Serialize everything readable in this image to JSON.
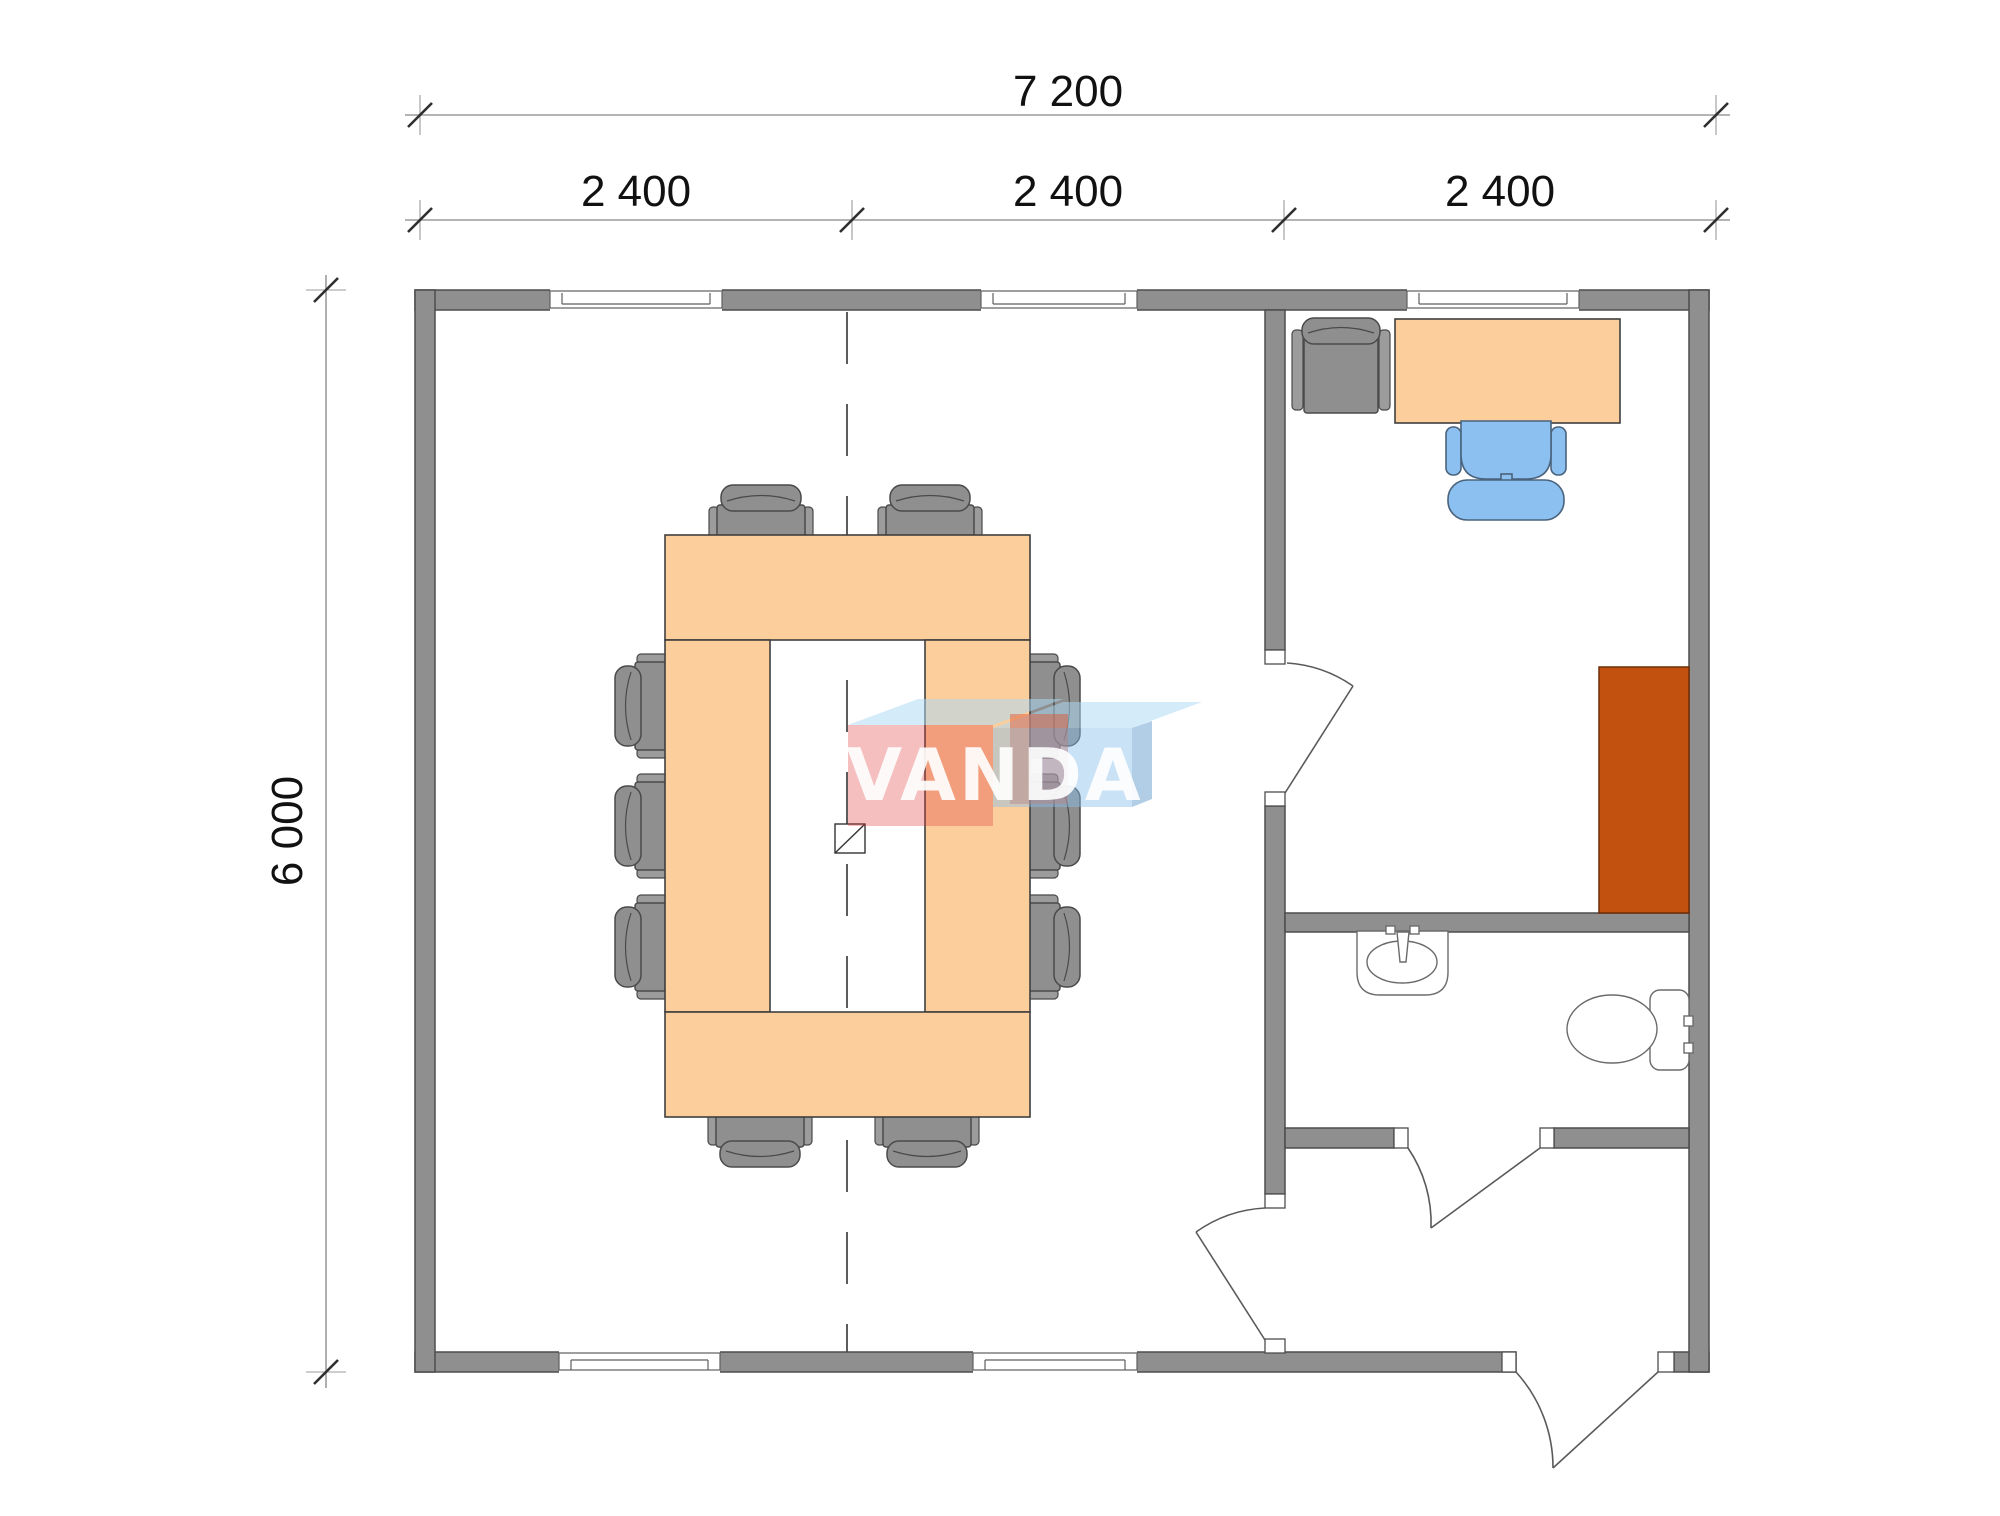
{
  "dimensions": {
    "total_width": "7 200",
    "bays": [
      "2 400",
      "2 400",
      "2 400"
    ],
    "total_height": "6 000"
  },
  "watermark": {
    "text": "VANDA"
  },
  "colors": {
    "wall-fill": "#8F8F8F",
    "wall-stroke": "#4D4D4D",
    "table-fill": "#FBCE9B",
    "table-stroke": "#3F3F3F",
    "cabinet-fill": "#C2500F",
    "chair-gray-fill": "#8F8F8F",
    "chair-blue-fill": "#8CC0F0",
    "logo-red": "rgba(226,62,62,0.33)",
    "logo-red-deep": "rgba(224,80,40,0.45)",
    "logo-blue": "rgba(138,190,235,0.45)",
    "logo-blue-top": "rgba(173,216,245,0.52)",
    "logo-blue-side": "rgba(108,160,208,0.52)"
  }
}
